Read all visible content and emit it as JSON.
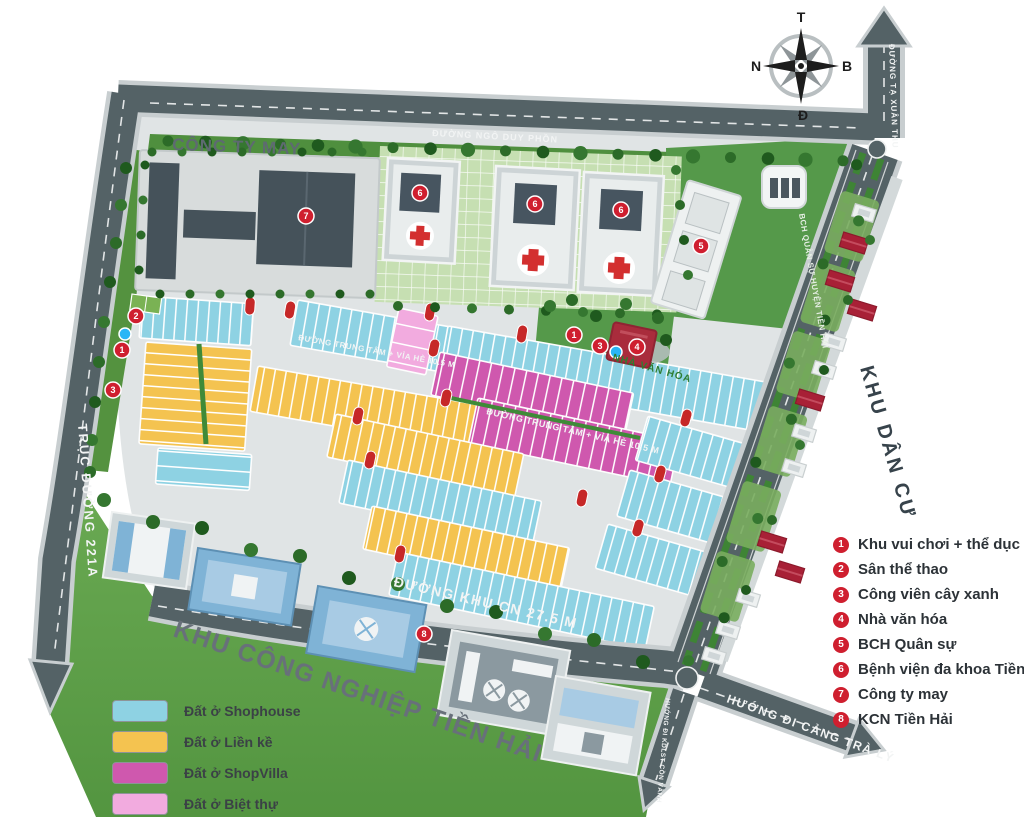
{
  "compass": {
    "top": "T",
    "right": "B",
    "bottom": "Đ",
    "left": "N"
  },
  "roads": {
    "ngo_duy_phon": "ĐƯỜNG NGÔ DUY PHỒN",
    "ta_xuan_thu": "ĐƯỜNG TẠ XUÂN THU",
    "truc_duong_221a": "TRỤC ĐƯỜNG 221A",
    "trung_tam_1": "ĐƯỜNG TRUNG TÂM + VỈA HÈ 10.5 M",
    "trung_tam_2": "ĐƯỜNG TRUNG TÂM + VỈA HÈ 10.5 M",
    "khu_cn": "ĐƯỜNG KHU CN 27.5 M",
    "cang_tra_ly": "HƯỚNG ĐI CẢNG TRÀ LÝ",
    "con_vanh": "HƯỚNG ĐI KDLST CỒN VÀNH"
  },
  "areas": {
    "cong_ty_may": "CÔNG TY MAY",
    "khu_dan_cu": "KHU DÂN CƯ",
    "khu_cong_nghiep": "KHU CÔNG NGHIỆP TIỀN HẢI",
    "nha_van_hoa": "NHÀ VĂN HÓA",
    "bch_quan_su": "BCH QUÂN SỰ HUYỆN TIỀN HẢI"
  },
  "zone_legend": {
    "items": [
      {
        "label": "Đất ở Shophouse",
        "color": "#8ed2e3"
      },
      {
        "label": "Đất ở Liền kề",
        "color": "#f4c350"
      },
      {
        "label": "Đất ở ShopVilla",
        "color": "#cf58ae"
      },
      {
        "label": "Đất ở Biệt thự",
        "color": "#f2abdf"
      }
    ]
  },
  "poi_legend": {
    "marker_color": "#cf1f2f",
    "items": [
      {
        "num": "1",
        "label": "Khu vui chơi + thể dục"
      },
      {
        "num": "2",
        "label": "Sân thể thao"
      },
      {
        "num": "3",
        "label": "Công viên cây xanh"
      },
      {
        "num": "4",
        "label": "Nhà văn hóa"
      },
      {
        "num": "5",
        "label": "BCH Quân sự"
      },
      {
        "num": "6",
        "label": "Bệnh viện đa khoa Tiền Hải"
      },
      {
        "num": "7",
        "label": "Công ty may"
      },
      {
        "num": "8",
        "label": "KCN Tiền Hải"
      }
    ]
  },
  "map_markers": [
    {
      "num": "2",
      "x": 136,
      "y": 316
    },
    {
      "num": "1",
      "x": 122,
      "y": 350
    },
    {
      "num": "3",
      "x": 113,
      "y": 390
    },
    {
      "num": "7",
      "x": 306,
      "y": 216
    },
    {
      "num": "6",
      "x": 420,
      "y": 193
    },
    {
      "num": "6",
      "x": 535,
      "y": 204
    },
    {
      "num": "6",
      "x": 621,
      "y": 210
    },
    {
      "num": "5",
      "x": 701,
      "y": 246
    },
    {
      "num": "1",
      "x": 574,
      "y": 335
    },
    {
      "num": "3",
      "x": 600,
      "y": 346
    },
    {
      "num": "4",
      "x": 637,
      "y": 347
    },
    {
      "num": "8",
      "x": 424,
      "y": 634
    }
  ]
}
